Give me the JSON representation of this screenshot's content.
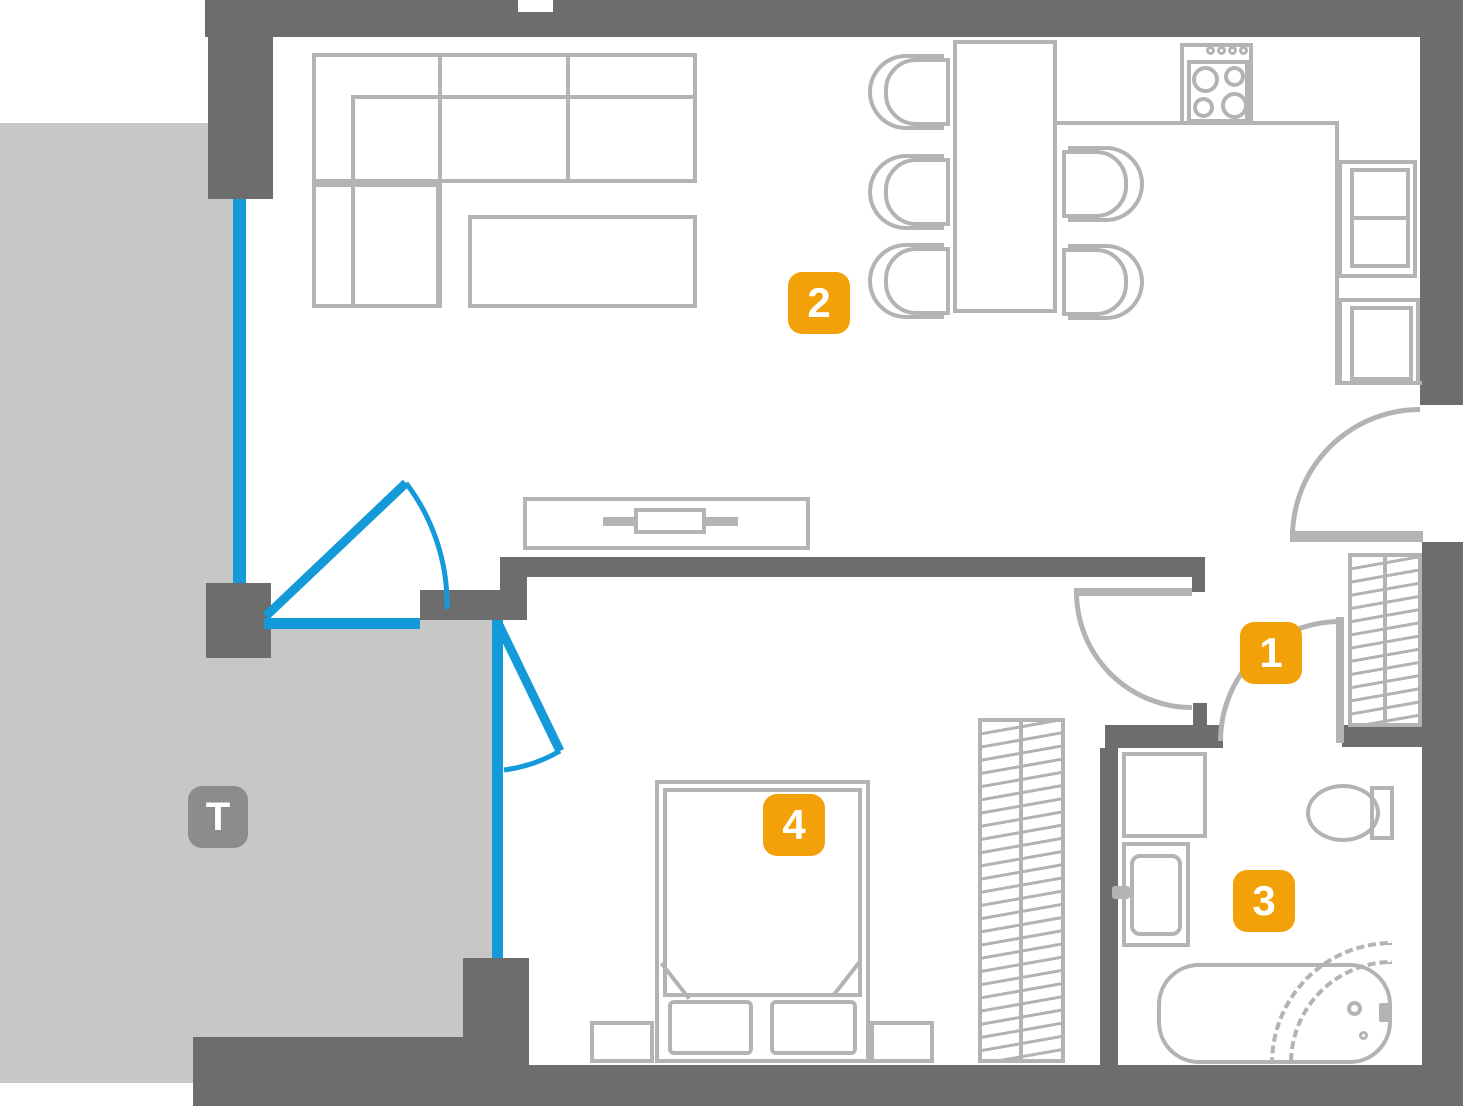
{
  "floorplan": {
    "badges": {
      "hallway": {
        "label": "1"
      },
      "living": {
        "label": "2"
      },
      "bathroom": {
        "label": "3"
      },
      "bedroom": {
        "label": "4"
      },
      "terrace": {
        "label": "T"
      }
    },
    "colors": {
      "wall": "#6d6d6d",
      "furniture_outline": "#b3b3b3",
      "terrace_floor": "#c7c7c7",
      "window_glazing": "#149ad9",
      "badge_accent": "#f2a208",
      "terrace_badge": "#8c8c8c",
      "badge_text": "#ffffff"
    }
  }
}
